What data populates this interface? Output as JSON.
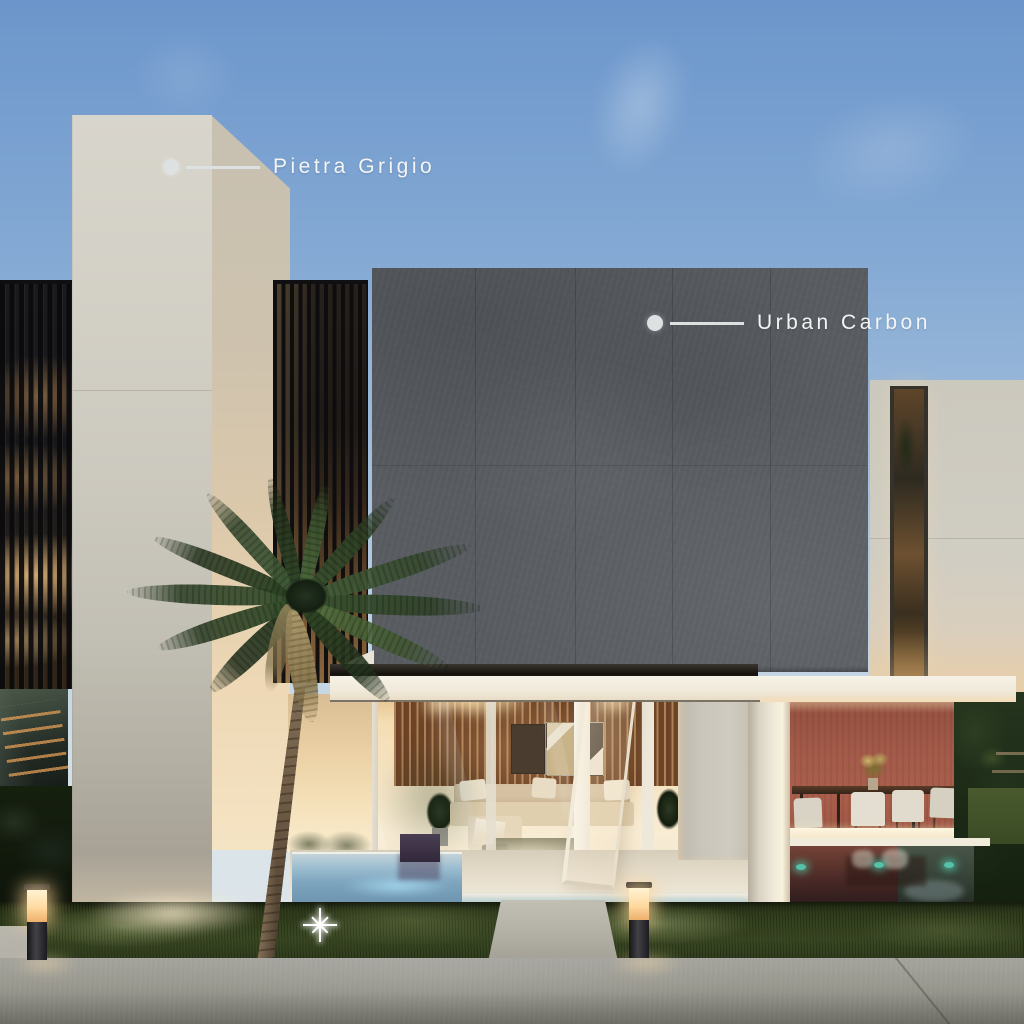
{
  "annotations": [
    {
      "id": "pietra-grigio",
      "label": "Pietra Grigio"
    },
    {
      "id": "urban-carbon",
      "label": "Urban Carbon"
    }
  ],
  "materials": {
    "pietra_grigio_hex": "#d2cfc6",
    "urban_carbon_hex": "#585c61"
  },
  "colors": {
    "sky_top": "#6c96cb",
    "sky_horizon": "#e0e7ea",
    "stone_light": "#d2cfc6",
    "carbon": "#585c61",
    "terracotta": "#a35a49",
    "wood_wall": "#6d4428",
    "lawn": "#33401e",
    "concrete": "#9b9a93",
    "led_blue": "#aadcf2",
    "pool_teal": "#54c2a8",
    "label_text": "#f3f5f5",
    "label_line": "#dde1e1",
    "warm_glow": "#ffd9a0"
  }
}
